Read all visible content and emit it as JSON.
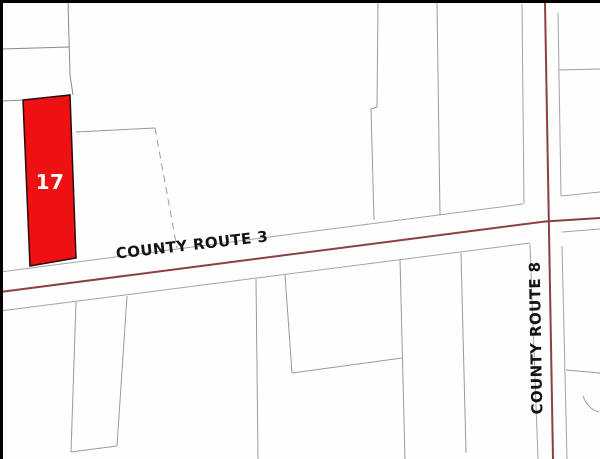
{
  "map": {
    "type": "tax-parcel-map",
    "highlighted_parcel": {
      "label": "17",
      "fill_color": "#ee1111",
      "outline_color": "#2a0a0a",
      "label_color": "#ffffff"
    },
    "roads": [
      {
        "name": "COUNTY ROUTE 3",
        "orientation": "horizontal",
        "centerline_color": "#8b4043"
      },
      {
        "name": "COUNTY ROUTE 8",
        "orientation": "vertical",
        "centerline_color": "#8b4043"
      }
    ],
    "colors": {
      "background": "#ffffff",
      "parcel_boundary_line": "#999999",
      "map_border": "#000000",
      "road_centerline": "#8b4043",
      "parcel_fill": "#ee1111",
      "parcel_label_text": "#ffffff",
      "road_label_text": "#141414"
    }
  }
}
